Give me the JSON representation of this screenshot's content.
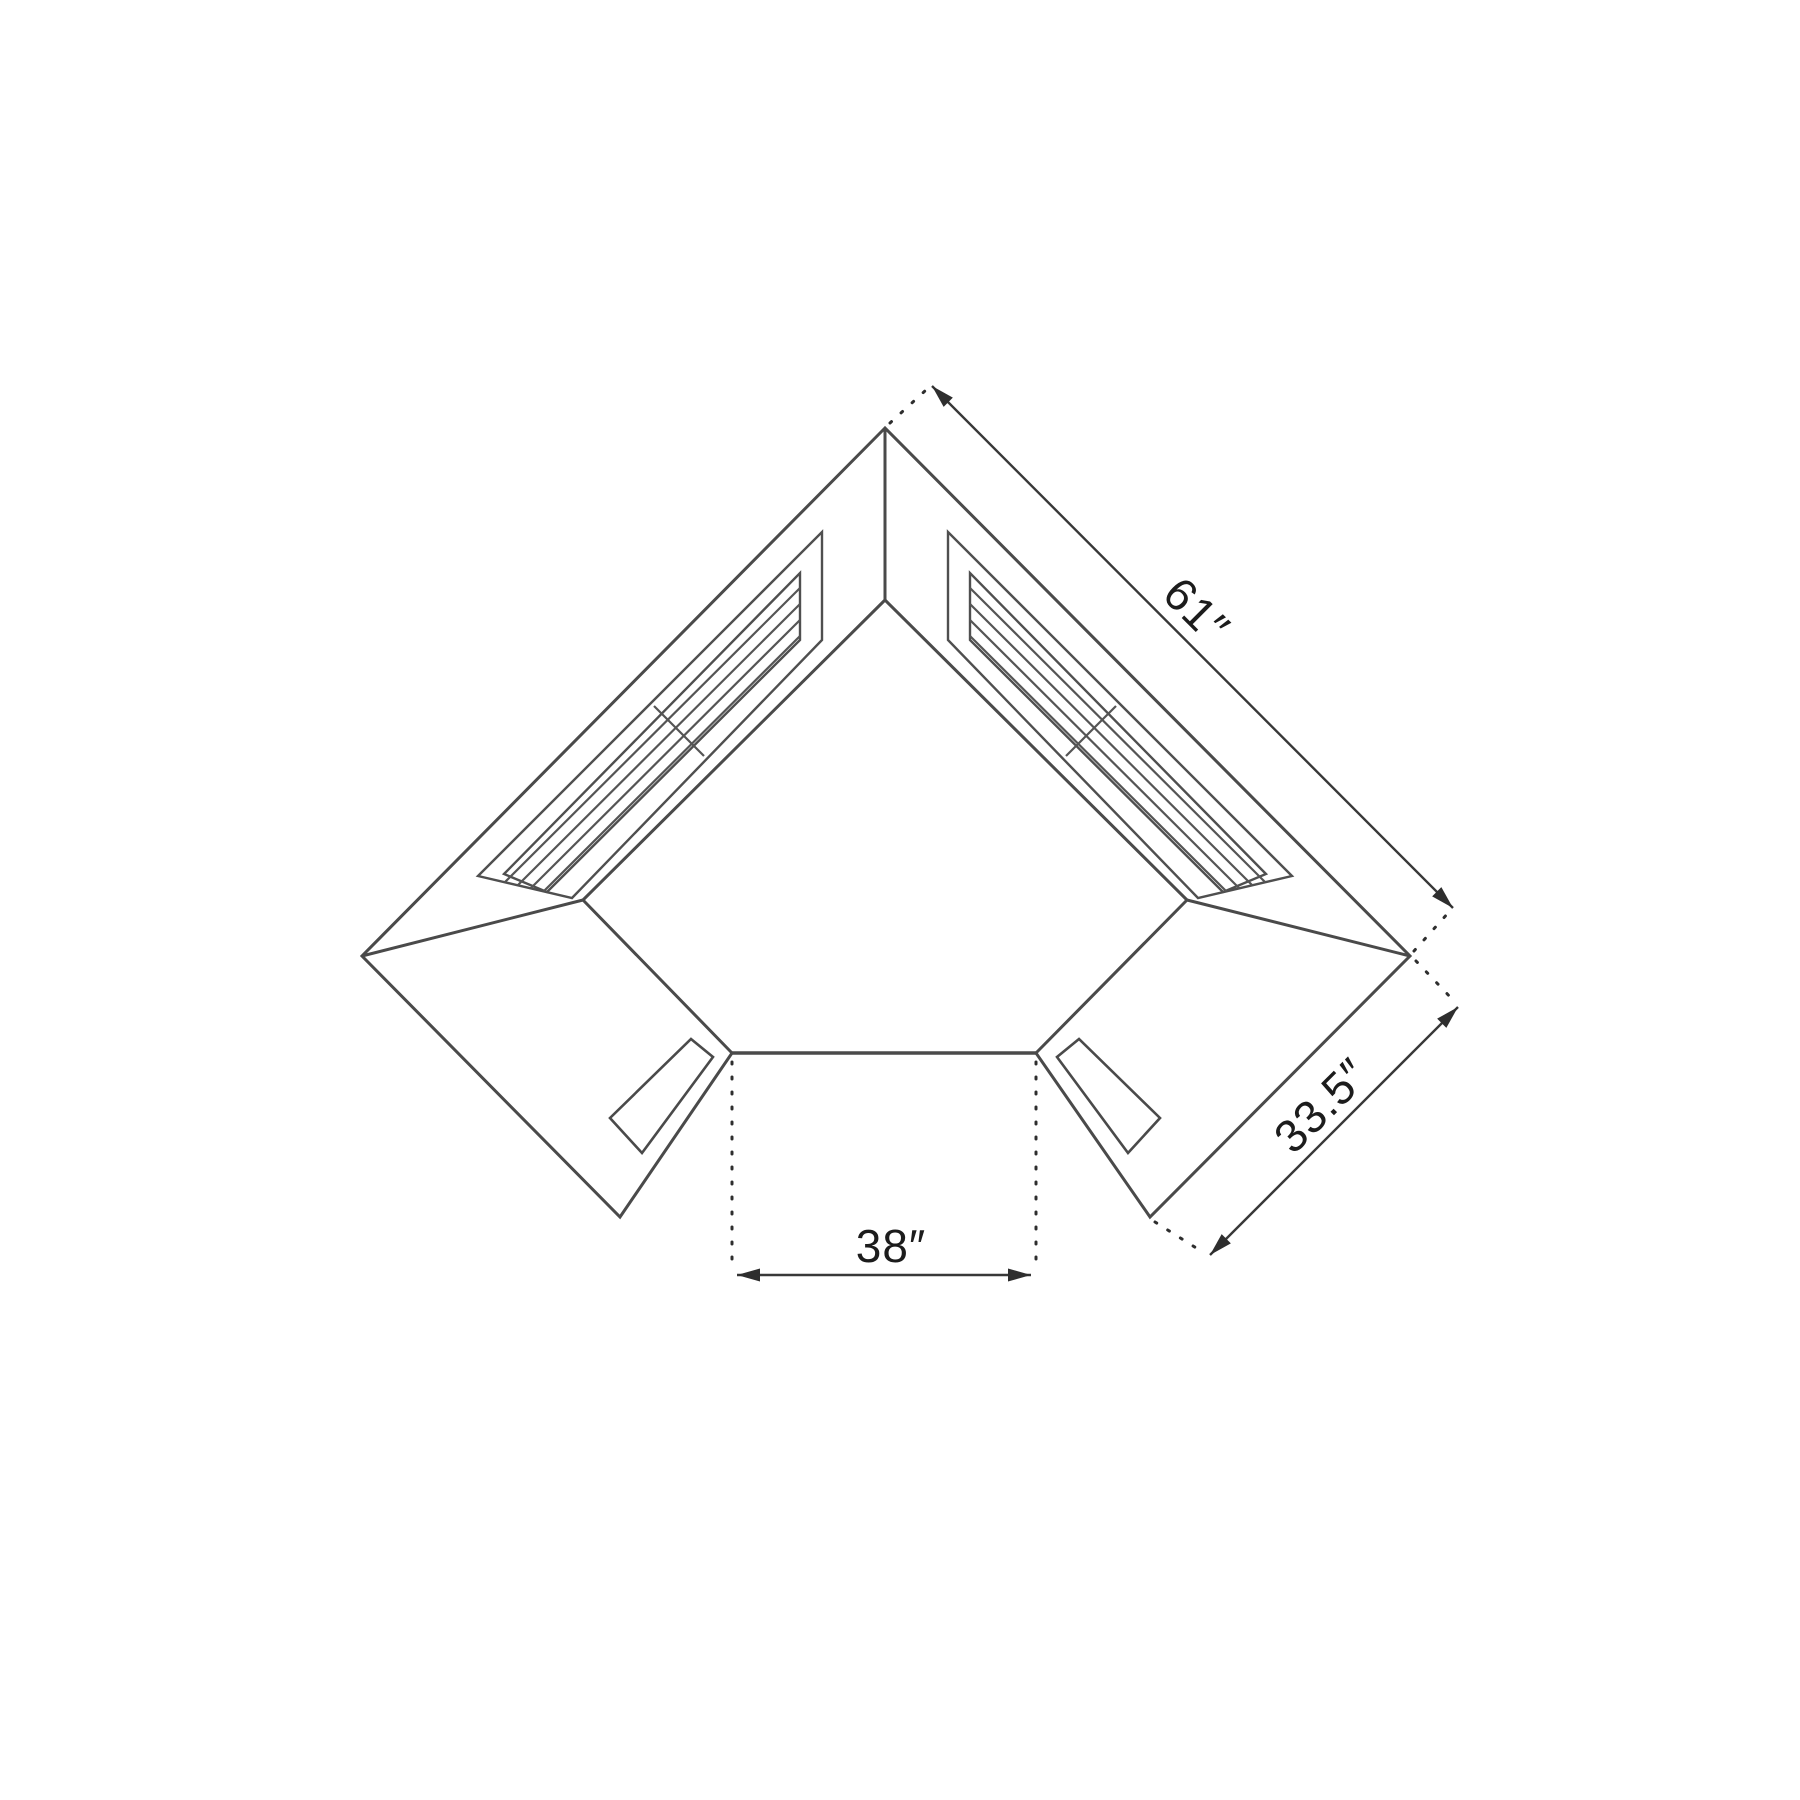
{
  "diagram": {
    "kind": "corner-sauna-floor-plan-top-view",
    "background_color": "#ffffff",
    "line_color": "#4a4a4a",
    "dimension_line_color": "#383838",
    "text_color": "#1c1c1c",
    "dimensions": {
      "top_right_edge_label": "61″",
      "lower_right_edge_label": "33.5″",
      "front_opening_label": "38″"
    }
  }
}
